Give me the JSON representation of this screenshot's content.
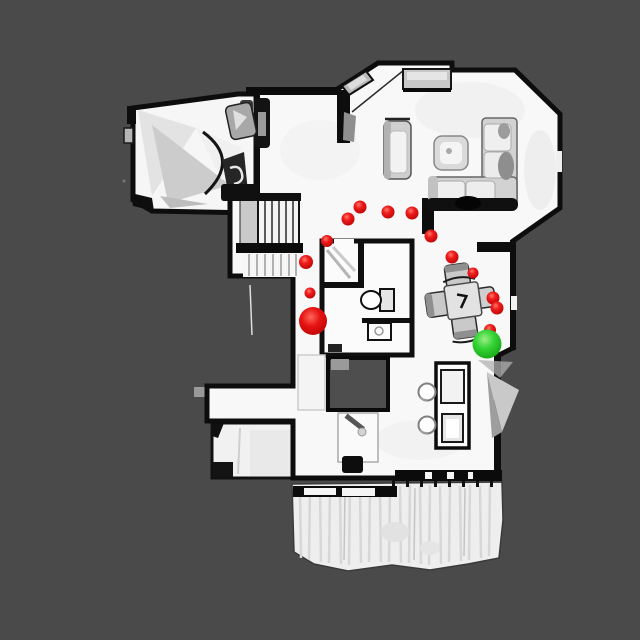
{
  "scene": {
    "type": "top-down-3d-house-scan",
    "background_color": "#4a4a4a",
    "floor_color": "#f8f8f8",
    "wall_color": "#0d0d0d",
    "deck_color": "#efefef",
    "furniture_color": "#d2d2d2"
  },
  "markers": {
    "waypoint_color": "#e01212",
    "start_color": "#e01212",
    "goal_color": "#2bc42b",
    "waypoints": [
      {
        "x": 306,
        "y": 262,
        "r": 7
      },
      {
        "x": 310,
        "y": 293,
        "r": 5.5
      },
      {
        "x": 327,
        "y": 241,
        "r": 6
      },
      {
        "x": 348,
        "y": 219,
        "r": 6.5
      },
      {
        "x": 360,
        "y": 207,
        "r": 6.5
      },
      {
        "x": 388,
        "y": 212,
        "r": 6.5
      },
      {
        "x": 412,
        "y": 213,
        "r": 6.5
      },
      {
        "x": 431,
        "y": 236,
        "r": 6.5
      },
      {
        "x": 452,
        "y": 257,
        "r": 6.5
      },
      {
        "x": 473,
        "y": 273,
        "r": 5.5
      },
      {
        "x": 493,
        "y": 298,
        "r": 6.5
      },
      {
        "x": 497,
        "y": 308,
        "r": 6.5
      },
      {
        "x": 490,
        "y": 330,
        "r": 6
      }
    ],
    "start_marker": {
      "x": 313,
      "y": 321,
      "r": 14
    },
    "goal_marker": {
      "x": 487,
      "y": 344,
      "r": 14.5
    }
  }
}
